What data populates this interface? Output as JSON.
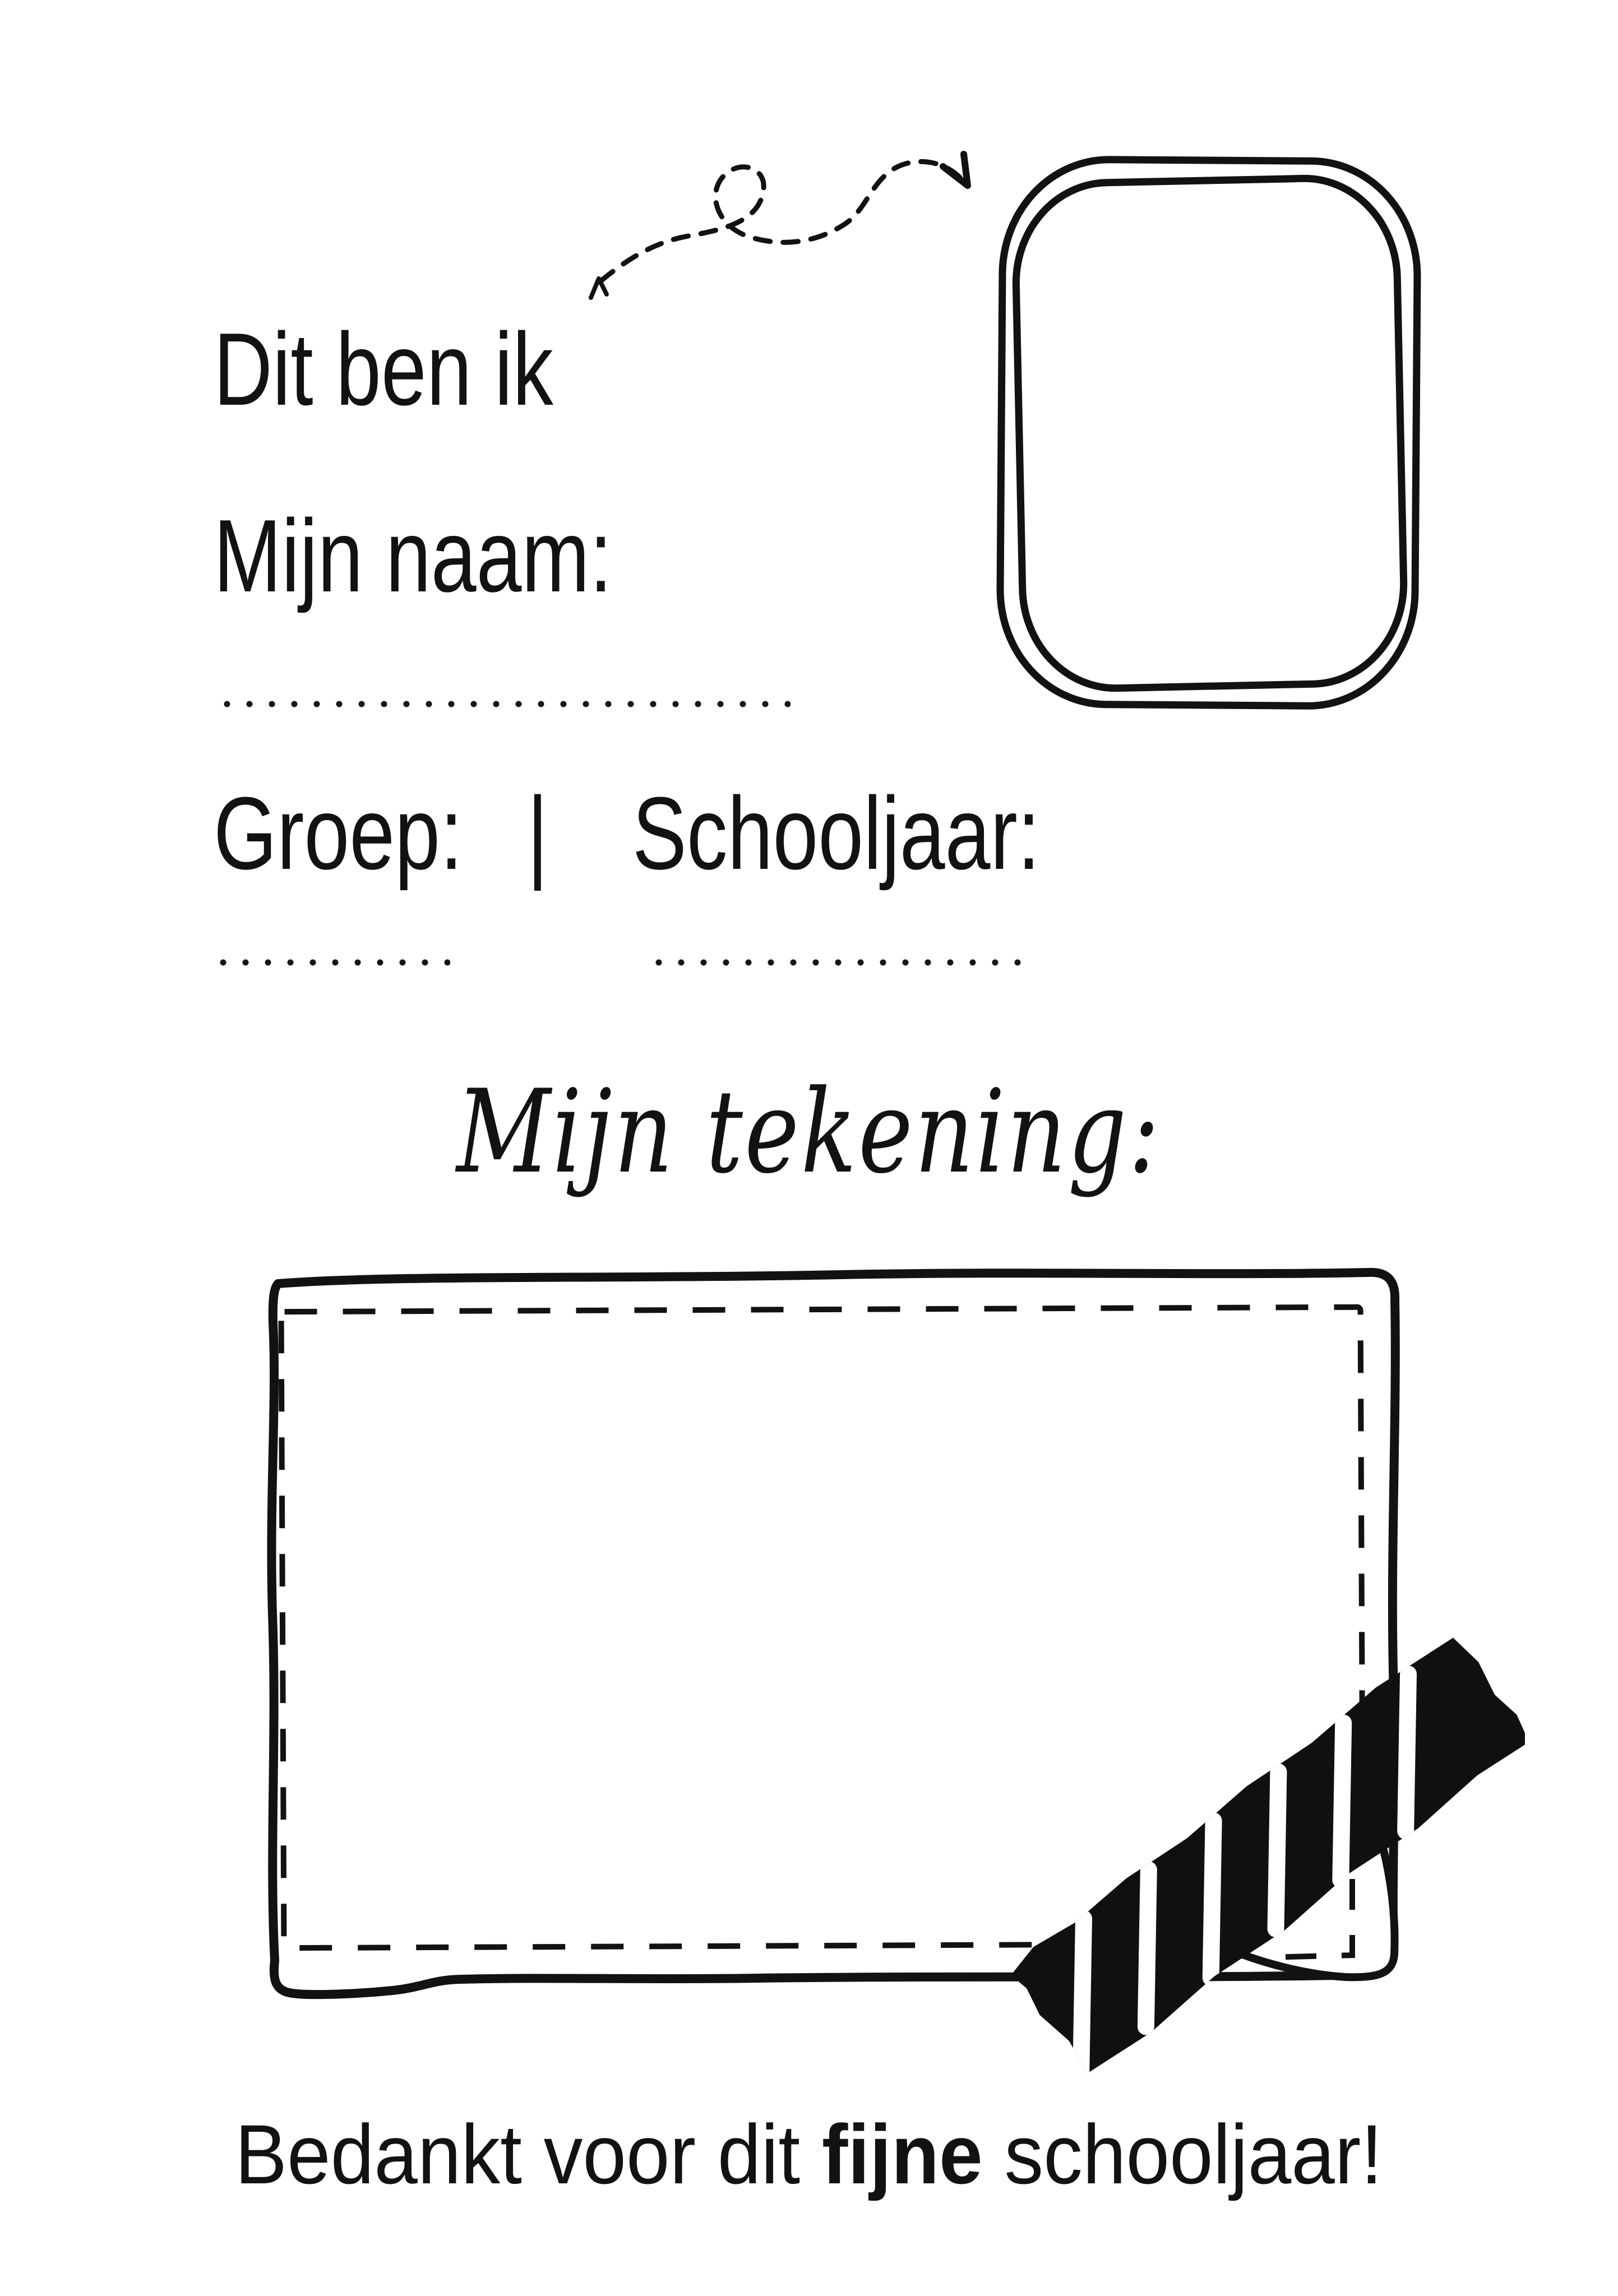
{
  "page": {
    "kind": "printable worksheet",
    "language": "nl",
    "colors": {
      "paper": "#ffffff",
      "ink": "#121212",
      "tape": "#101010",
      "tape_stripe": "#ffffff"
    }
  },
  "identity": {
    "title": "Dit ben ik",
    "name_label": "Mijn naam:",
    "name_value": "",
    "group_label": "Groep:",
    "divider": "|",
    "schoolyear_label": "Schooljaar:",
    "group_value": "",
    "schoolyear_value": ""
  },
  "drawing": {
    "caption": "Mijn tekening:",
    "canvas_value": ""
  },
  "footer": {
    "message_prefix": "Bedankt voor dit ",
    "message_emphasis": "fijne",
    "message_suffix": " schooljaar!"
  },
  "decorations": {
    "arrow": "dashed-squiggle-arrow pointing to photo frame",
    "frame": "hand-drawn double-outline photo frame",
    "box": "hand-drawn rectangle with dashed inner border",
    "tape": "black washi tape with white diagonal stripes over folded paper corner"
  }
}
